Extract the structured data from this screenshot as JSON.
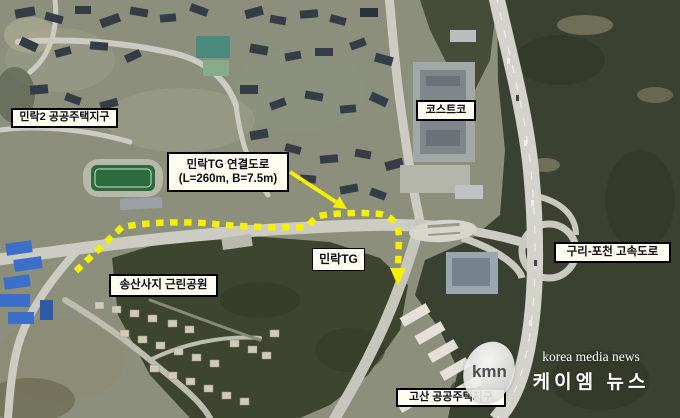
{
  "map": {
    "labels": {
      "minrak2_district": "민락2 공공주택지구",
      "costco": "코스트코",
      "connection_road_title": "민락TG 연결도로",
      "connection_road_spec": "(L=260m, B=7.5m)",
      "minrak_tg": "민락TG",
      "expressway": "구리-포천 고속도로",
      "park": "송산사지 근린공원",
      "gosan_district": "고산 공공주택지구"
    },
    "route": {
      "description": "connection-road-alignment",
      "color": "#f4f000",
      "style": "dashed"
    }
  },
  "watermark": {
    "logo_text": "kmn",
    "agency_en": "korea media news",
    "agency_ko": "케이엠 뉴스"
  }
}
